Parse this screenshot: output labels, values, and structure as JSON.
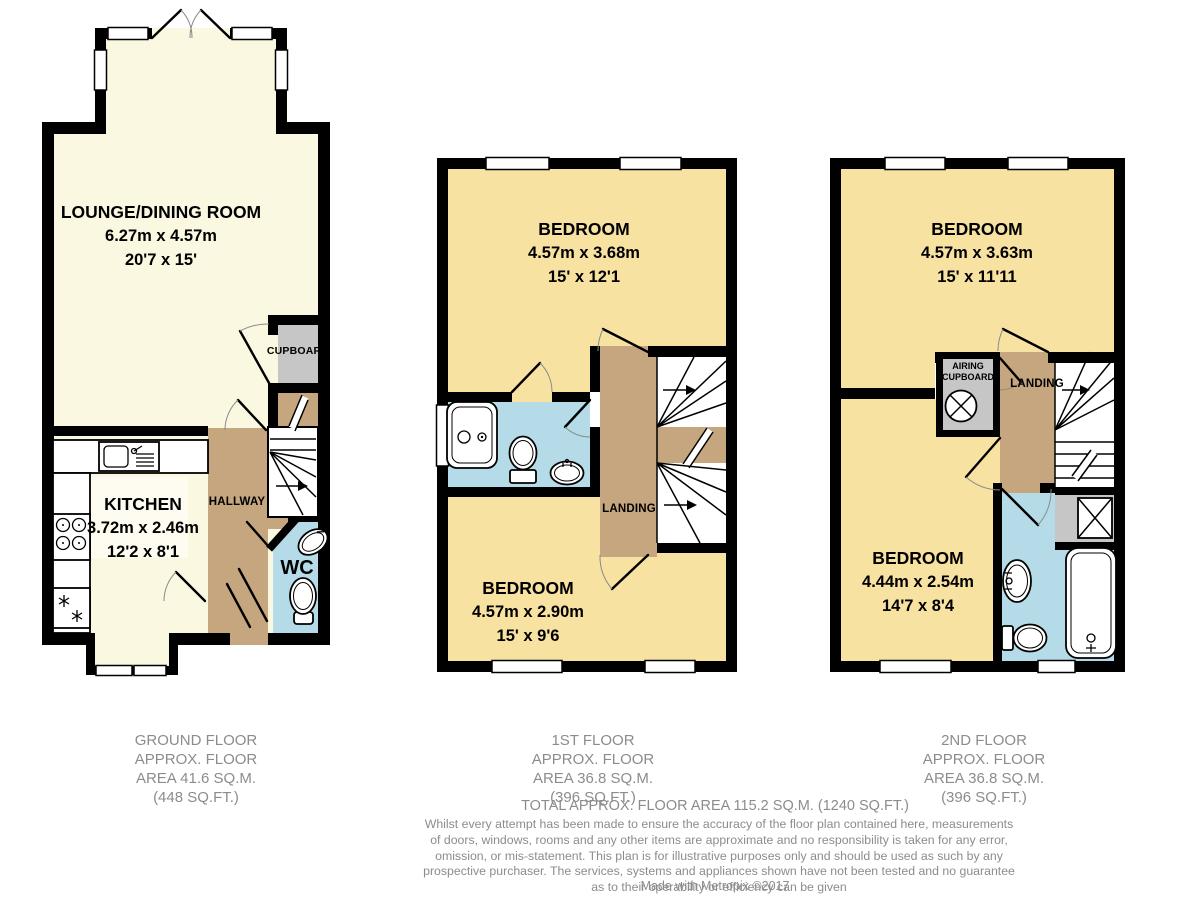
{
  "colors": {
    "cream": "#FBF8E1",
    "cream_light": "#FEFCF0",
    "wheat": "#F7E2A2",
    "tan": "#C5A67E",
    "blue": "#B5DBE8",
    "gray": "#C6C6C6",
    "wall": "#000000",
    "caption_text": "#8C8C8C"
  },
  "floors": {
    "ground": {
      "caption": [
        "GROUND FLOOR",
        "APPROX. FLOOR",
        "AREA 41.6 SQ.M.",
        "(448 SQ.FT.)"
      ],
      "lounge": {
        "name": "LOUNGE/DINING ROOM",
        "metric": "6.27m x 4.57m",
        "imperial": "20'7 x 15'"
      },
      "kitchen": {
        "name": "KITCHEN",
        "metric": "3.72m x 2.46m",
        "imperial": "12'2 x 8'1"
      },
      "cupboard": "CUPBOARD",
      "hallway": "HALLWAY",
      "wc": "WC"
    },
    "first": {
      "caption": [
        "1ST FLOOR",
        "APPROX. FLOOR",
        "AREA 36.8 SQ.M.",
        "(396 SQ.FT.)"
      ],
      "bedroom1": {
        "name": "BEDROOM",
        "metric": "4.57m x 3.68m",
        "imperial": "15' x 12'1"
      },
      "bedroom2": {
        "name": "BEDROOM",
        "metric": "4.57m x 2.90m",
        "imperial": "15' x 9'6"
      },
      "landing": "LANDING"
    },
    "second": {
      "caption": [
        "2ND FLOOR",
        "APPROX. FLOOR",
        "AREA 36.8 SQ.M.",
        "(396 SQ.FT.)"
      ],
      "bedroom1": {
        "name": "BEDROOM",
        "metric": "4.57m x 3.63m",
        "imperial": "15' x 11'11"
      },
      "bedroom2": {
        "name": "BEDROOM",
        "metric": "4.44m x 2.54m",
        "imperial": "14'7 x 8'4"
      },
      "airing": "AIRING CUPBOARD",
      "landing": "LANDING"
    }
  },
  "summary": {
    "total": "TOTAL APPROX. FLOOR AREA 115.2 SQ.M. (1240 SQ.FT.)",
    "disclaimer": [
      "Whilst every attempt has been made to ensure the accuracy of the floor plan contained here, measurements",
      "of doors, windows, rooms and any other items are approximate and no responsibility is taken for any error,",
      "omission, or mis-statement. This plan is for illustrative purposes only and should be used as such by any",
      "prospective purchaser. The services, systems and appliances shown have not been tested and no guarantee",
      "as to their operability or efficiency can be given"
    ],
    "credit": "Made with Metropix ©2017"
  }
}
